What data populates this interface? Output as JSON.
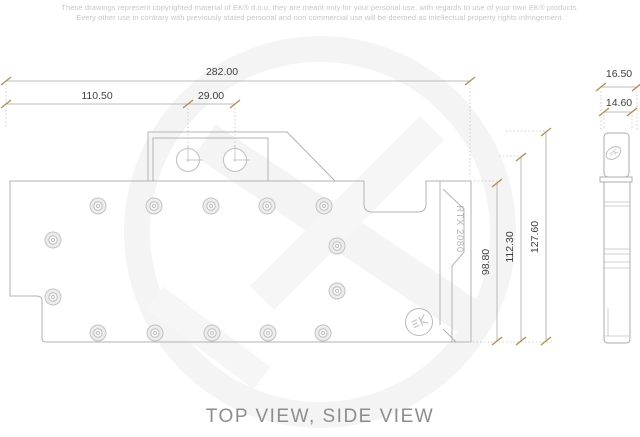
{
  "disclaimer": {
    "line1": "These drawings represent copyrighted material of EK® d.o.o, they are meant only for your personal use, with regards to use of your own EK® products.",
    "line2": "Every other use in contrary with previously stated personal and non commercial use will be deemed as intellectual property rights infringement."
  },
  "footer": {
    "title": "TOP VIEW, SIDE VIEW"
  },
  "drawing": {
    "product_label": "RTX 2080",
    "dimensions": {
      "total_width": "282.00",
      "left_section_width": "110.50",
      "port_spacing": "29.00",
      "side_outer_width": "16.50",
      "side_inner_width": "14.60",
      "body_height": "98.80",
      "mid_height": "112.30",
      "total_height": "127.60"
    }
  },
  "badges": {
    "ek_monogram": "EK"
  },
  "colors": {
    "outline": "#b3b3b3",
    "dimension_line": "#a9a9a9",
    "dimension_tick": "#b08f58",
    "dimension_text": "#3d3d3d",
    "watermark": "#f4f4f4",
    "label_text": "#b5b5b5"
  }
}
